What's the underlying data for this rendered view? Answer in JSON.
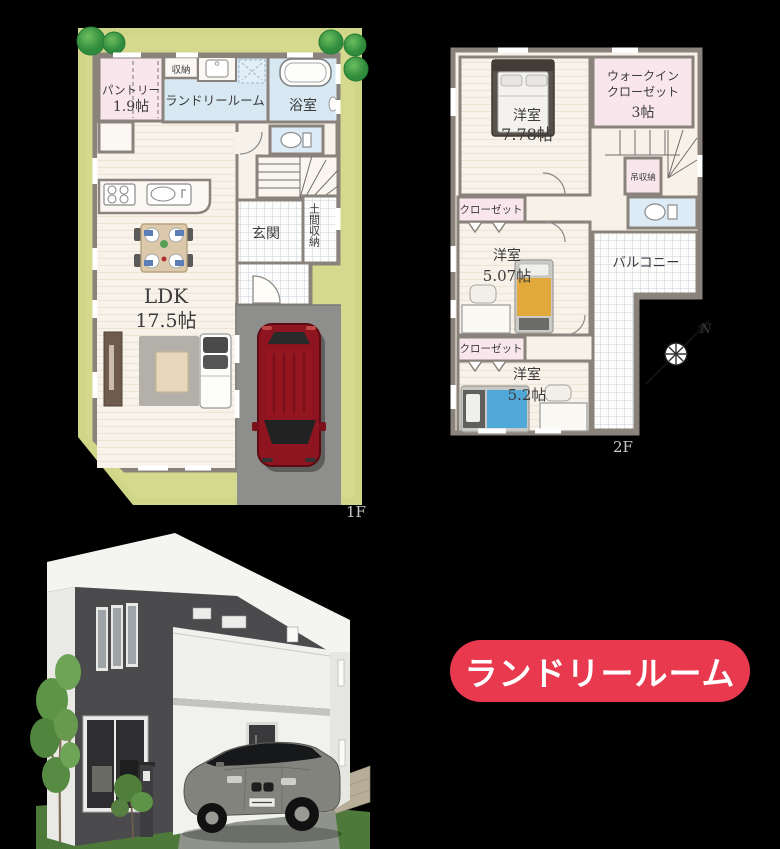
{
  "floor1": {
    "floor_label": "1F",
    "pantry_name": "パントリー",
    "pantry_size": "1.9帖",
    "storage": "収納",
    "laundry": "ランドリールーム",
    "bath": "浴室",
    "entrance": "玄関",
    "doma": "土間収納",
    "ldk_name": "LDK",
    "ldk_size": "17.5帖"
  },
  "floor2": {
    "floor_label": "2F",
    "bedroom1_name": "洋室",
    "bedroom1_size": "7.78帖",
    "wic_line1": "ウォークイン",
    "wic_line2": "クローゼット",
    "wic_size": "3帖",
    "hanging_storage": "吊収納",
    "closet1": "クローゼット",
    "bedroom2_name": "洋室",
    "bedroom2_size": "5.07帖",
    "closet2": "クローゼット",
    "bedroom3_name": "洋室",
    "bedroom3_size": "5.2帖",
    "balcony": "バルコニー",
    "compass_north": "N"
  },
  "badge": {
    "label": "ランドリールーム",
    "bg_color": "#E8394F",
    "text_color": "#FFFFFF"
  },
  "colors": {
    "background": "#000000",
    "yard_green": "#CFD687",
    "wall_gray": "#8A837C",
    "floor_cream": "#F8F3EA",
    "room_pink": "#F8E6EC",
    "room_blue": "#D7E8F3",
    "driveway_gray": "#8E8E8C",
    "car_red": "#8E1520",
    "house_dark": "#4B4B4D",
    "house_white": "#F4F4F1",
    "lawn_green": "#4D7A3A"
  }
}
